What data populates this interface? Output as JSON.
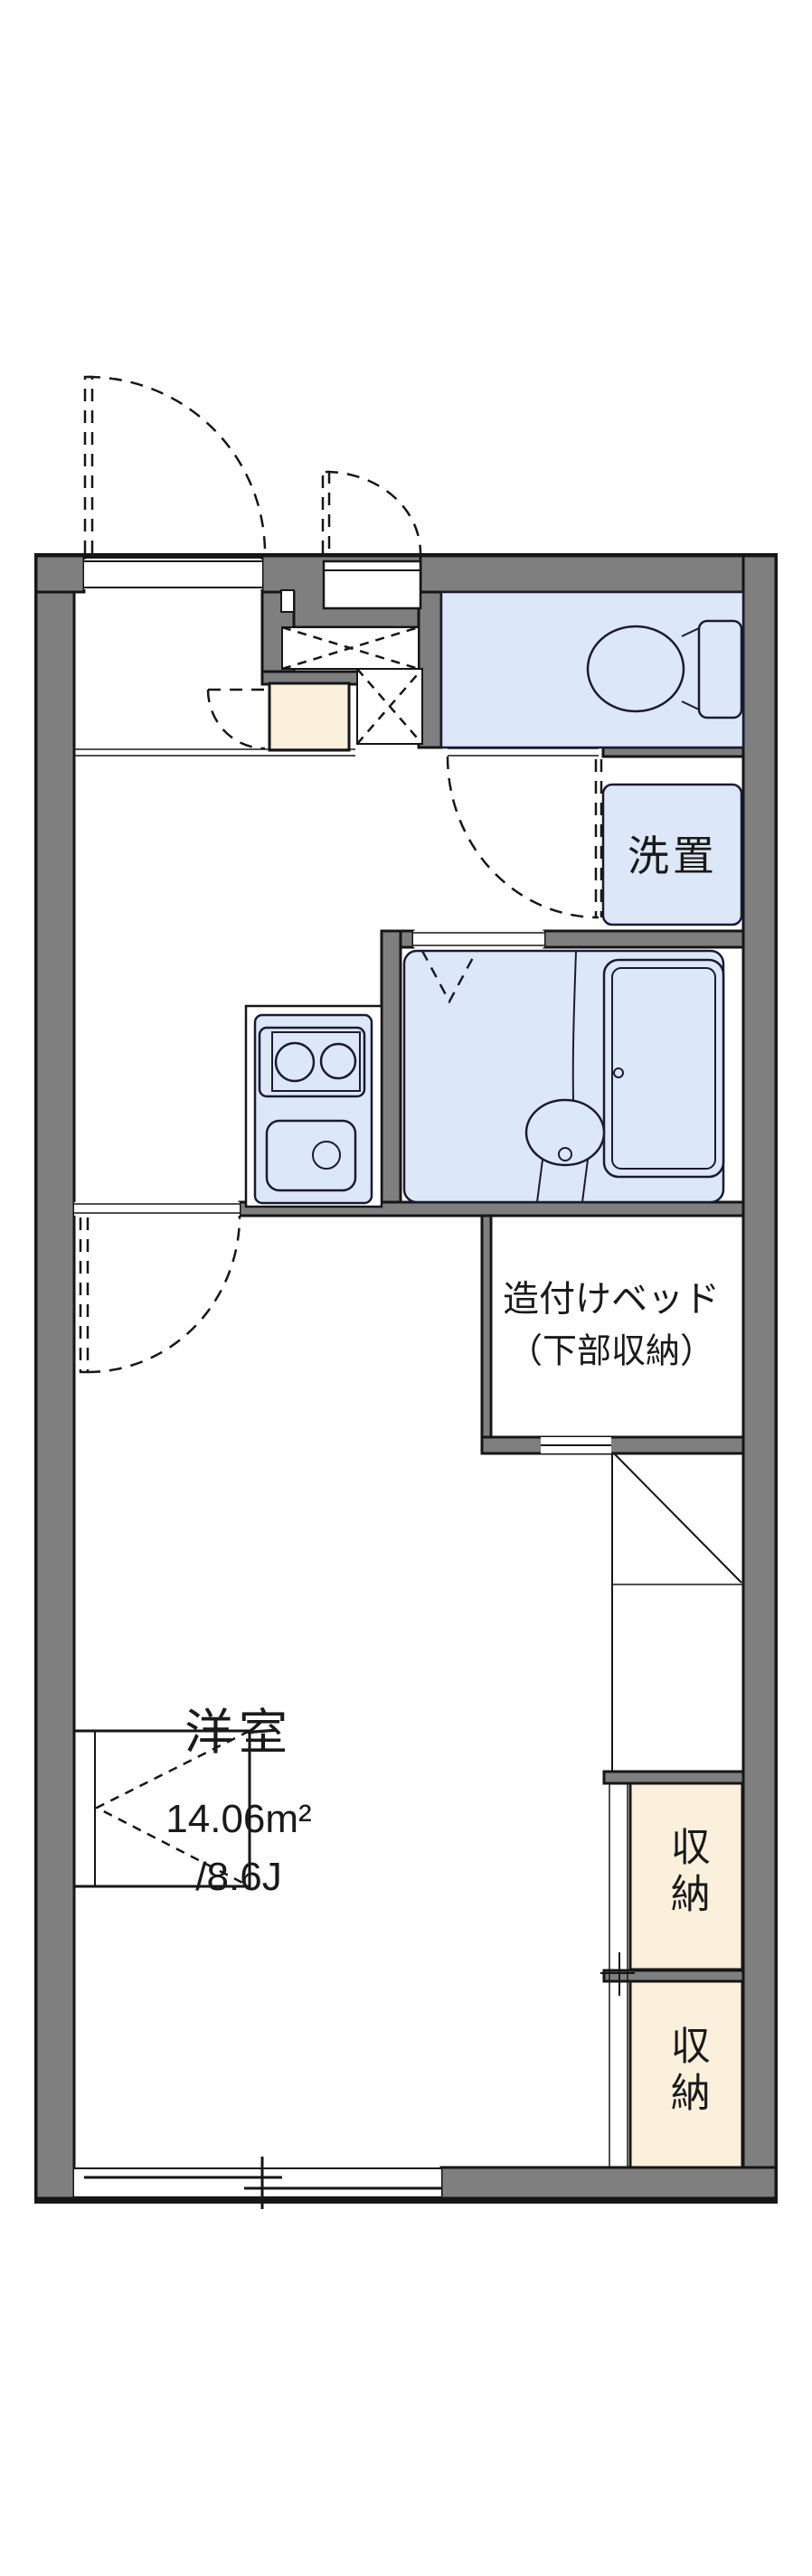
{
  "labels": {
    "washer_storage": "洗置",
    "built_in_bed_line1": "造付けベッド",
    "built_in_bed_line2": "（下部収納）",
    "western_room": "洋室",
    "area_sqm": "14.06m²",
    "area_tatami": "/8.6J",
    "storage_top": "収納",
    "storage_bottom": "収納"
  },
  "colors": {
    "wall_fill": "#7f7f7f",
    "outline": "#161616",
    "wet_area_fill": "#dce8f7",
    "fixture_line": "#1b1b33",
    "storage_fill": "#faf0dc",
    "background": "#ffffff",
    "text": "#1a1a1a"
  }
}
